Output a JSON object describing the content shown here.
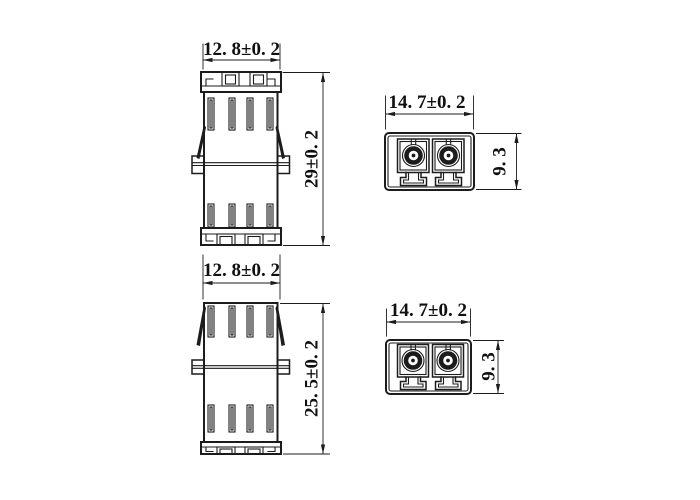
{
  "colors": {
    "ink": "#1c1c1c",
    "background": "#ffffff"
  },
  "dims": {
    "side_top_width": "12. 8±0. 2",
    "side_top_height": "29±0. 2",
    "front_top_width": "14. 7±0. 2",
    "front_top_height": "9. 3",
    "side_bottom_width": "12. 8±0. 2",
    "side_bottom_height": "25. 5±0. 2",
    "front_bottom_width": "14. 7±0. 2",
    "front_bottom_height": "9. 3"
  }
}
